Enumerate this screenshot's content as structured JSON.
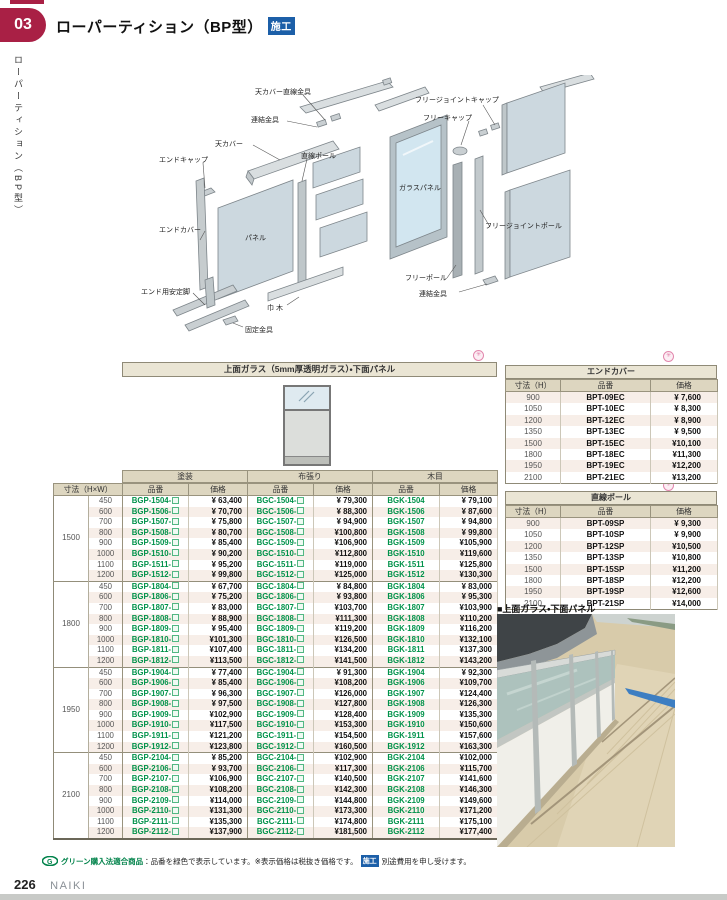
{
  "page": {
    "chapter_number": "03",
    "title": "ローパーティション（BP型）",
    "title_badge": "施工",
    "sidebar_text": "ローパーティション（BP型）",
    "page_number": "226",
    "brand": "NAIKI",
    "footer_green_label": "グリーン購入法適合商品",
    "footer_note_1": "：品番を緑色で表示しています。※表示価格は税抜き価格です。",
    "footer_badge": "施工",
    "footer_note_2": "別途費用を申し受けます。"
  },
  "icons": {
    "order_mark": "✳",
    "green_logo_letter": "G",
    "caption_square": "■"
  },
  "colors": {
    "accent_red": "#a92045",
    "badge_blue": "#1c5fa8",
    "code_green": "#00924a",
    "header_beige": "#ddd6c0",
    "titlebar_beige": "#eae5d4",
    "stripe_pink": "#f7eee8",
    "footer_green": "#00824a",
    "order_mark_pink": "#e287ad"
  },
  "diagram": {
    "labels": [
      {
        "text": "天カバー直線金具"
      },
      {
        "text": "連結金具"
      },
      {
        "text": "天カバー"
      },
      {
        "text": "エンドキャップ"
      },
      {
        "text": "直線ポール"
      },
      {
        "text": "エンドカバー"
      },
      {
        "text": "パネル"
      },
      {
        "text": "エンド用安定脚"
      },
      {
        "text": "固定金具"
      },
      {
        "text": "巾 木"
      },
      {
        "text": "フリージョイントキャップ"
      },
      {
        "text": "フリーキャップ"
      },
      {
        "text": "ガラスパネル"
      },
      {
        "text": "フリージョイントポール"
      },
      {
        "text": "フリーポール"
      },
      {
        "text": "連結金具"
      }
    ]
  },
  "main_table": {
    "title": "上面ガラス（5mm厚透明ガラス）・下面パネル",
    "size_header": "寸法（H×W）",
    "col_groups": [
      "塗装",
      "布張り",
      "木目"
    ],
    "sub_headers": [
      "品番",
      "価格"
    ],
    "groups": [
      {
        "h": "1500",
        "rows": [
          [
            "450",
            "BGP-1504-",
            "¥ 63,400",
            "BGC-1504-",
            "¥ 79,300",
            "BGK-1504",
            "¥ 79,100"
          ],
          [
            "600",
            "BGP-1506-",
            "¥ 70,700",
            "BGC-1506-",
            "¥ 88,300",
            "BGK-1506",
            "¥ 87,600"
          ],
          [
            "700",
            "BGP-1507-",
            "¥ 75,800",
            "BGC-1507-",
            "¥ 94,900",
            "BGK-1507",
            "¥ 94,800"
          ],
          [
            "800",
            "BGP-1508-",
            "¥ 80,700",
            "BGC-1508-",
            "¥100,800",
            "BGK-1508",
            "¥ 99,800"
          ],
          [
            "900",
            "BGP-1509-",
            "¥ 85,400",
            "BGC-1509-",
            "¥106,900",
            "BGK-1509",
            "¥105,900"
          ],
          [
            "1000",
            "BGP-1510-",
            "¥ 90,200",
            "BGC-1510-",
            "¥112,800",
            "BGK-1510",
            "¥119,600"
          ],
          [
            "1100",
            "BGP-1511-",
            "¥ 95,200",
            "BGC-1511-",
            "¥119,000",
            "BGK-1511",
            "¥125,800"
          ],
          [
            "1200",
            "BGP-1512-",
            "¥ 99,800",
            "BGC-1512-",
            "¥125,000",
            "BGK-1512",
            "¥130,300"
          ]
        ]
      },
      {
        "h": "1800",
        "rows": [
          [
            "450",
            "BGP-1804-",
            "¥ 67,700",
            "BGC-1804-",
            "¥ 84,800",
            "BGK-1804",
            "¥ 83,000"
          ],
          [
            "600",
            "BGP-1806-",
            "¥ 75,200",
            "BGC-1806-",
            "¥ 93,800",
            "BGK-1806",
            "¥ 95,300"
          ],
          [
            "700",
            "BGP-1807-",
            "¥ 83,000",
            "BGC-1807-",
            "¥103,700",
            "BGK-1807",
            "¥103,900"
          ],
          [
            "800",
            "BGP-1808-",
            "¥ 88,900",
            "BGC-1808-",
            "¥111,300",
            "BGK-1808",
            "¥110,200"
          ],
          [
            "900",
            "BGP-1809-",
            "¥ 95,400",
            "BGC-1809-",
            "¥119,200",
            "BGK-1809",
            "¥116,200"
          ],
          [
            "1000",
            "BGP-1810-",
            "¥101,300",
            "BGC-1810-",
            "¥126,500",
            "BGK-1810",
            "¥132,100"
          ],
          [
            "1100",
            "BGP-1811-",
            "¥107,400",
            "BGC-1811-",
            "¥134,200",
            "BGK-1811",
            "¥137,300"
          ],
          [
            "1200",
            "BGP-1812-",
            "¥113,500",
            "BGC-1812-",
            "¥141,500",
            "BGK-1812",
            "¥143,200"
          ]
        ]
      },
      {
        "h": "1950",
        "rows": [
          [
            "450",
            "BGP-1904-",
            "¥ 77,400",
            "BGC-1904-",
            "¥ 91,300",
            "BGK-1904",
            "¥ 92,300"
          ],
          [
            "600",
            "BGP-1906-",
            "¥ 85,400",
            "BGC-1906-",
            "¥108,200",
            "BGK-1906",
            "¥109,700"
          ],
          [
            "700",
            "BGP-1907-",
            "¥ 96,300",
            "BGC-1907-",
            "¥126,000",
            "BGK-1907",
            "¥124,400"
          ],
          [
            "800",
            "BGP-1908-",
            "¥ 97,500",
            "BGC-1908-",
            "¥127,800",
            "BGK-1908",
            "¥126,300"
          ],
          [
            "900",
            "BGP-1909-",
            "¥102,900",
            "BGC-1909-",
            "¥128,400",
            "BGK-1909",
            "¥135,300"
          ],
          [
            "1000",
            "BGP-1910-",
            "¥117,500",
            "BGC-1910-",
            "¥153,300",
            "BGK-1910",
            "¥150,600"
          ],
          [
            "1100",
            "BGP-1911-",
            "¥121,200",
            "BGC-1911-",
            "¥154,500",
            "BGK-1911",
            "¥157,600"
          ],
          [
            "1200",
            "BGP-1912-",
            "¥123,800",
            "BGC-1912-",
            "¥160,500",
            "BGK-1912",
            "¥163,300"
          ]
        ]
      },
      {
        "h": "2100",
        "rows": [
          [
            "450",
            "BGP-2104-",
            "¥ 85,200",
            "BGC-2104-",
            "¥102,900",
            "BGK-2104",
            "¥102,000"
          ],
          [
            "600",
            "BGP-2106-",
            "¥ 93,700",
            "BGC-2106-",
            "¥117,300",
            "BGK-2106",
            "¥115,700"
          ],
          [
            "700",
            "BGP-2107-",
            "¥106,900",
            "BGC-2107-",
            "¥140,500",
            "BGK-2107",
            "¥141,600"
          ],
          [
            "800",
            "BGP-2108-",
            "¥108,200",
            "BGC-2108-",
            "¥142,300",
            "BGK-2108",
            "¥146,300"
          ],
          [
            "900",
            "BGP-2109-",
            "¥114,000",
            "BGC-2109-",
            "¥144,800",
            "BGK-2109",
            "¥149,600"
          ],
          [
            "1000",
            "BGP-2110-",
            "¥131,300",
            "BGC-2110-",
            "¥173,300",
            "BGK-2110",
            "¥171,200"
          ],
          [
            "1100",
            "BGP-2111-",
            "¥135,300",
            "BGC-2111-",
            "¥174,800",
            "BGK-2111",
            "¥175,100"
          ],
          [
            "1200",
            "BGP-2112-",
            "¥137,900",
            "BGC-2112-",
            "¥181,500",
            "BGK-2112",
            "¥177,400"
          ]
        ]
      }
    ]
  },
  "end_cover_table": {
    "title": "エンドカバー",
    "headers": [
      "寸法（H）",
      "品番",
      "価格"
    ],
    "rows": [
      [
        "900",
        "BPT-09EC",
        "¥ 7,600"
      ],
      [
        "1050",
        "BPT-10EC",
        "¥ 8,300"
      ],
      [
        "1200",
        "BPT-12EC",
        "¥ 8,900"
      ],
      [
        "1350",
        "BPT-13EC",
        "¥ 9,500"
      ],
      [
        "1500",
        "BPT-15EC",
        "¥10,100"
      ],
      [
        "1800",
        "BPT-18EC",
        "¥11,300"
      ],
      [
        "1950",
        "BPT-19EC",
        "¥12,200"
      ],
      [
        "2100",
        "BPT-21EC",
        "¥13,200"
      ]
    ]
  },
  "straight_pole_table": {
    "title": "直線ポール",
    "headers": [
      "寸法（H）",
      "品番",
      "価格"
    ],
    "rows": [
      [
        "900",
        "BPT-09SP",
        "¥ 9,300"
      ],
      [
        "1050",
        "BPT-10SP",
        "¥ 9,900"
      ],
      [
        "1200",
        "BPT-12SP",
        "¥10,500"
      ],
      [
        "1350",
        "BPT-13SP",
        "¥10,800"
      ],
      [
        "1500",
        "BPT-15SP",
        "¥11,200"
      ],
      [
        "1800",
        "BPT-18SP",
        "¥12,200"
      ],
      [
        "1950",
        "BPT-19SP",
        "¥12,600"
      ],
      [
        "2100",
        "BPT-21SP",
        "¥14,000"
      ]
    ]
  },
  "photo": {
    "caption": "■上面ガラス・下面パネル"
  }
}
